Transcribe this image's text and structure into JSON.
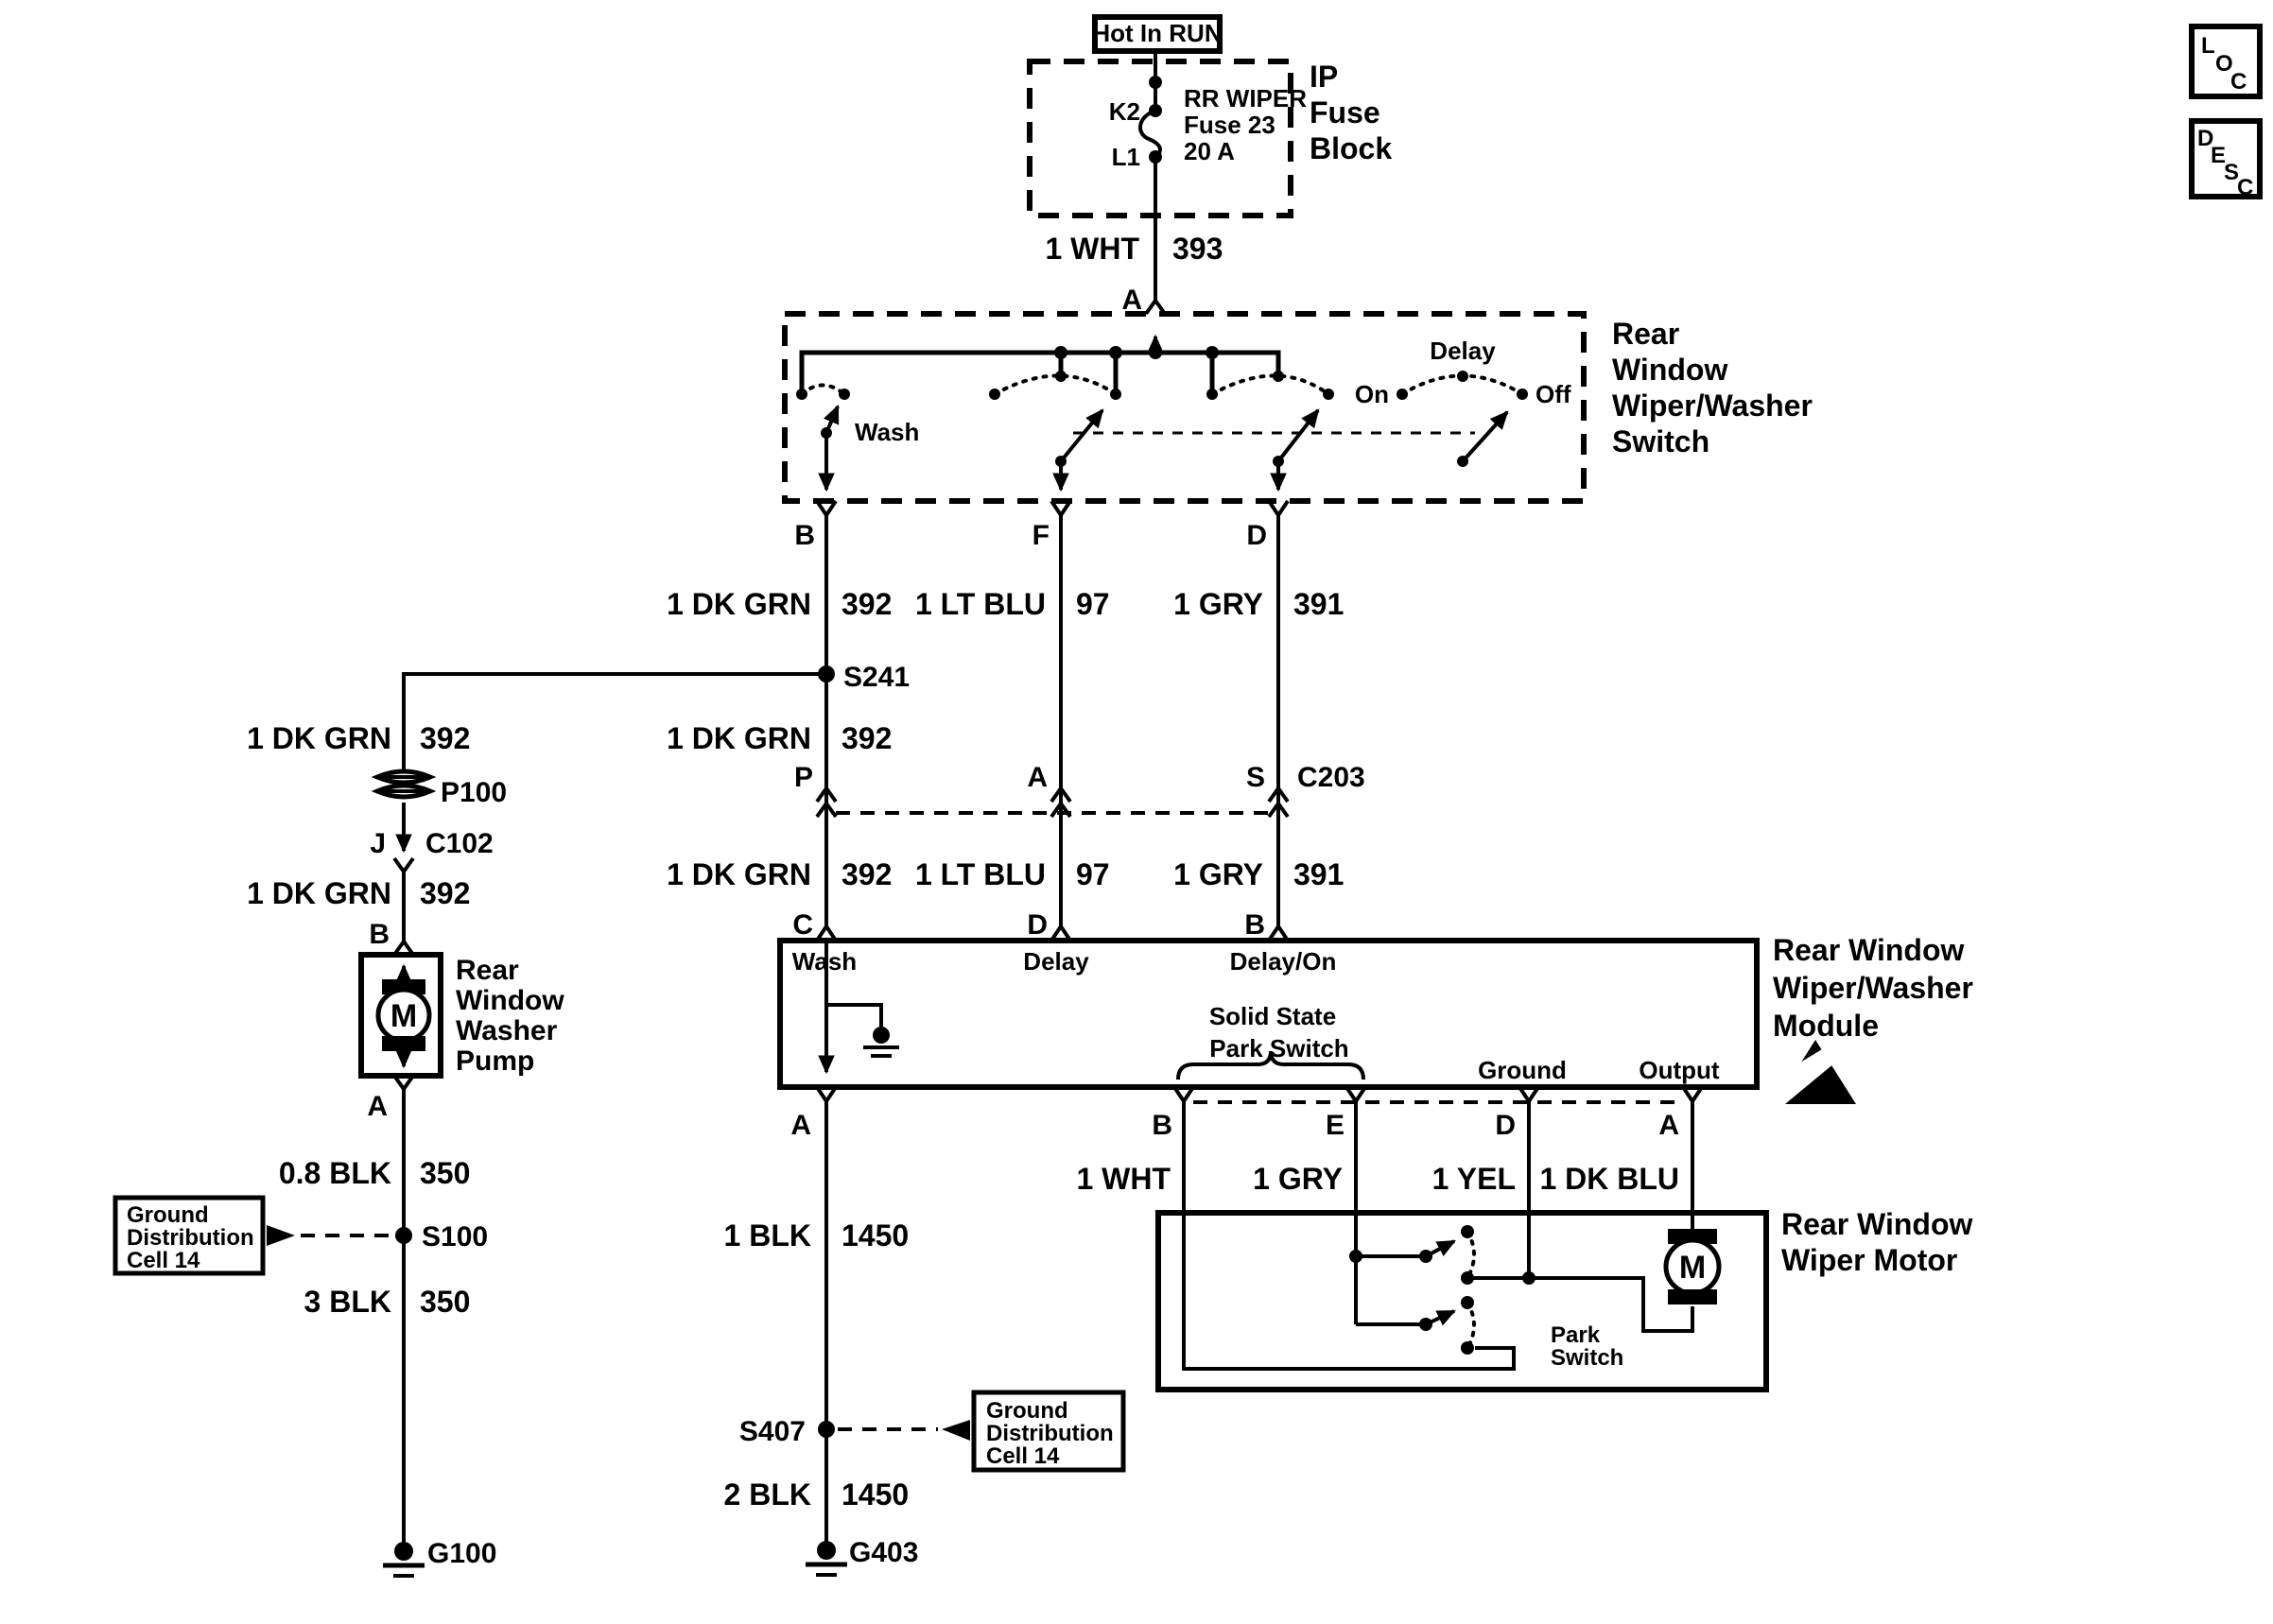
{
  "corner": {
    "loc": [
      "L",
      "O",
      "C"
    ],
    "desc": [
      "D",
      "E",
      "S",
      "C"
    ]
  },
  "power": {
    "hot_in_run": "Hot In RUN",
    "fuse_block": {
      "title": [
        "IP",
        "Fuse",
        "Block"
      ],
      "k2": "K2",
      "l1": "L1",
      "fuse": [
        "RR WIPER",
        "Fuse 23",
        "20 A"
      ]
    },
    "wire": {
      "color": "1 WHT",
      "circuit": "393"
    },
    "term_a": "A"
  },
  "switch": {
    "title": [
      "Rear",
      "Window",
      "Wiper/Washer",
      "Switch"
    ],
    "wash": "Wash",
    "on": "On",
    "delay": "Delay",
    "off": "Off",
    "term_b": "B",
    "term_f": "F",
    "term_d": "D"
  },
  "wires": {
    "row1": [
      {
        "color": "1 DK GRN",
        "circuit": "392"
      },
      {
        "color": "1 LT BLU",
        "circuit": "97"
      },
      {
        "color": "1 GRY",
        "circuit": "391"
      }
    ],
    "row2": {
      "color": "1 DK GRN",
      "circuit": "392"
    },
    "row3": [
      {
        "color": "1 DK GRN",
        "circuit": "392"
      },
      {
        "color": "1 LT BLU",
        "circuit": "97"
      },
      {
        "color": "1 GRY",
        "circuit": "391"
      }
    ],
    "out": [
      "1 WHT",
      "1 GRY",
      "1 YEL",
      "1 DK BLU"
    ],
    "left_top": {
      "color": "1 DK GRN",
      "circuit": "392"
    },
    "left_mid": {
      "color": "1 DK GRN",
      "circuit": "392"
    },
    "blk_0_8": {
      "color": "0.8 BLK",
      "circuit": "350"
    },
    "blk_3": {
      "color": "3 BLK",
      "circuit": "350"
    },
    "blk_1": {
      "color": "1 BLK",
      "circuit": "1450"
    },
    "blk_2": {
      "color": "2 BLK",
      "circuit": "1450"
    }
  },
  "connectors": {
    "c203": {
      "p": "P",
      "a": "A",
      "s": "S",
      "name": "C203"
    },
    "c102": {
      "j": "J",
      "name": "C102"
    },
    "p100": "P100"
  },
  "splices": {
    "s241": "S241",
    "s100": "S100",
    "s407": "S407"
  },
  "grounds": {
    "g100": "G100",
    "g403": "G403"
  },
  "ground_ref": [
    "Ground",
    "Distribution",
    "Cell 14"
  ],
  "module": {
    "title": [
      "Rear Window",
      "Wiper/Washer",
      "Module"
    ],
    "term_c": "C",
    "term_d": "D",
    "term_b": "B",
    "wash": "Wash",
    "delay": "Delay",
    "delay_on": "Delay/On",
    "solid_state": "Solid State",
    "park_switch": "Park Switch",
    "ground": "Ground",
    "output": "Output",
    "term_a_out": "A",
    "term_b_out": "B",
    "term_e_out": "E",
    "term_d_out": "D",
    "term_a2_out": "A"
  },
  "pump": {
    "title": [
      "Rear",
      "Window",
      "Washer",
      "Pump"
    ],
    "m": "M",
    "term_b": "B",
    "term_a": "A"
  },
  "motor": {
    "title": [
      "Rear Window",
      "Wiper Motor"
    ],
    "m": "M",
    "park": [
      "Park",
      "Switch"
    ]
  }
}
